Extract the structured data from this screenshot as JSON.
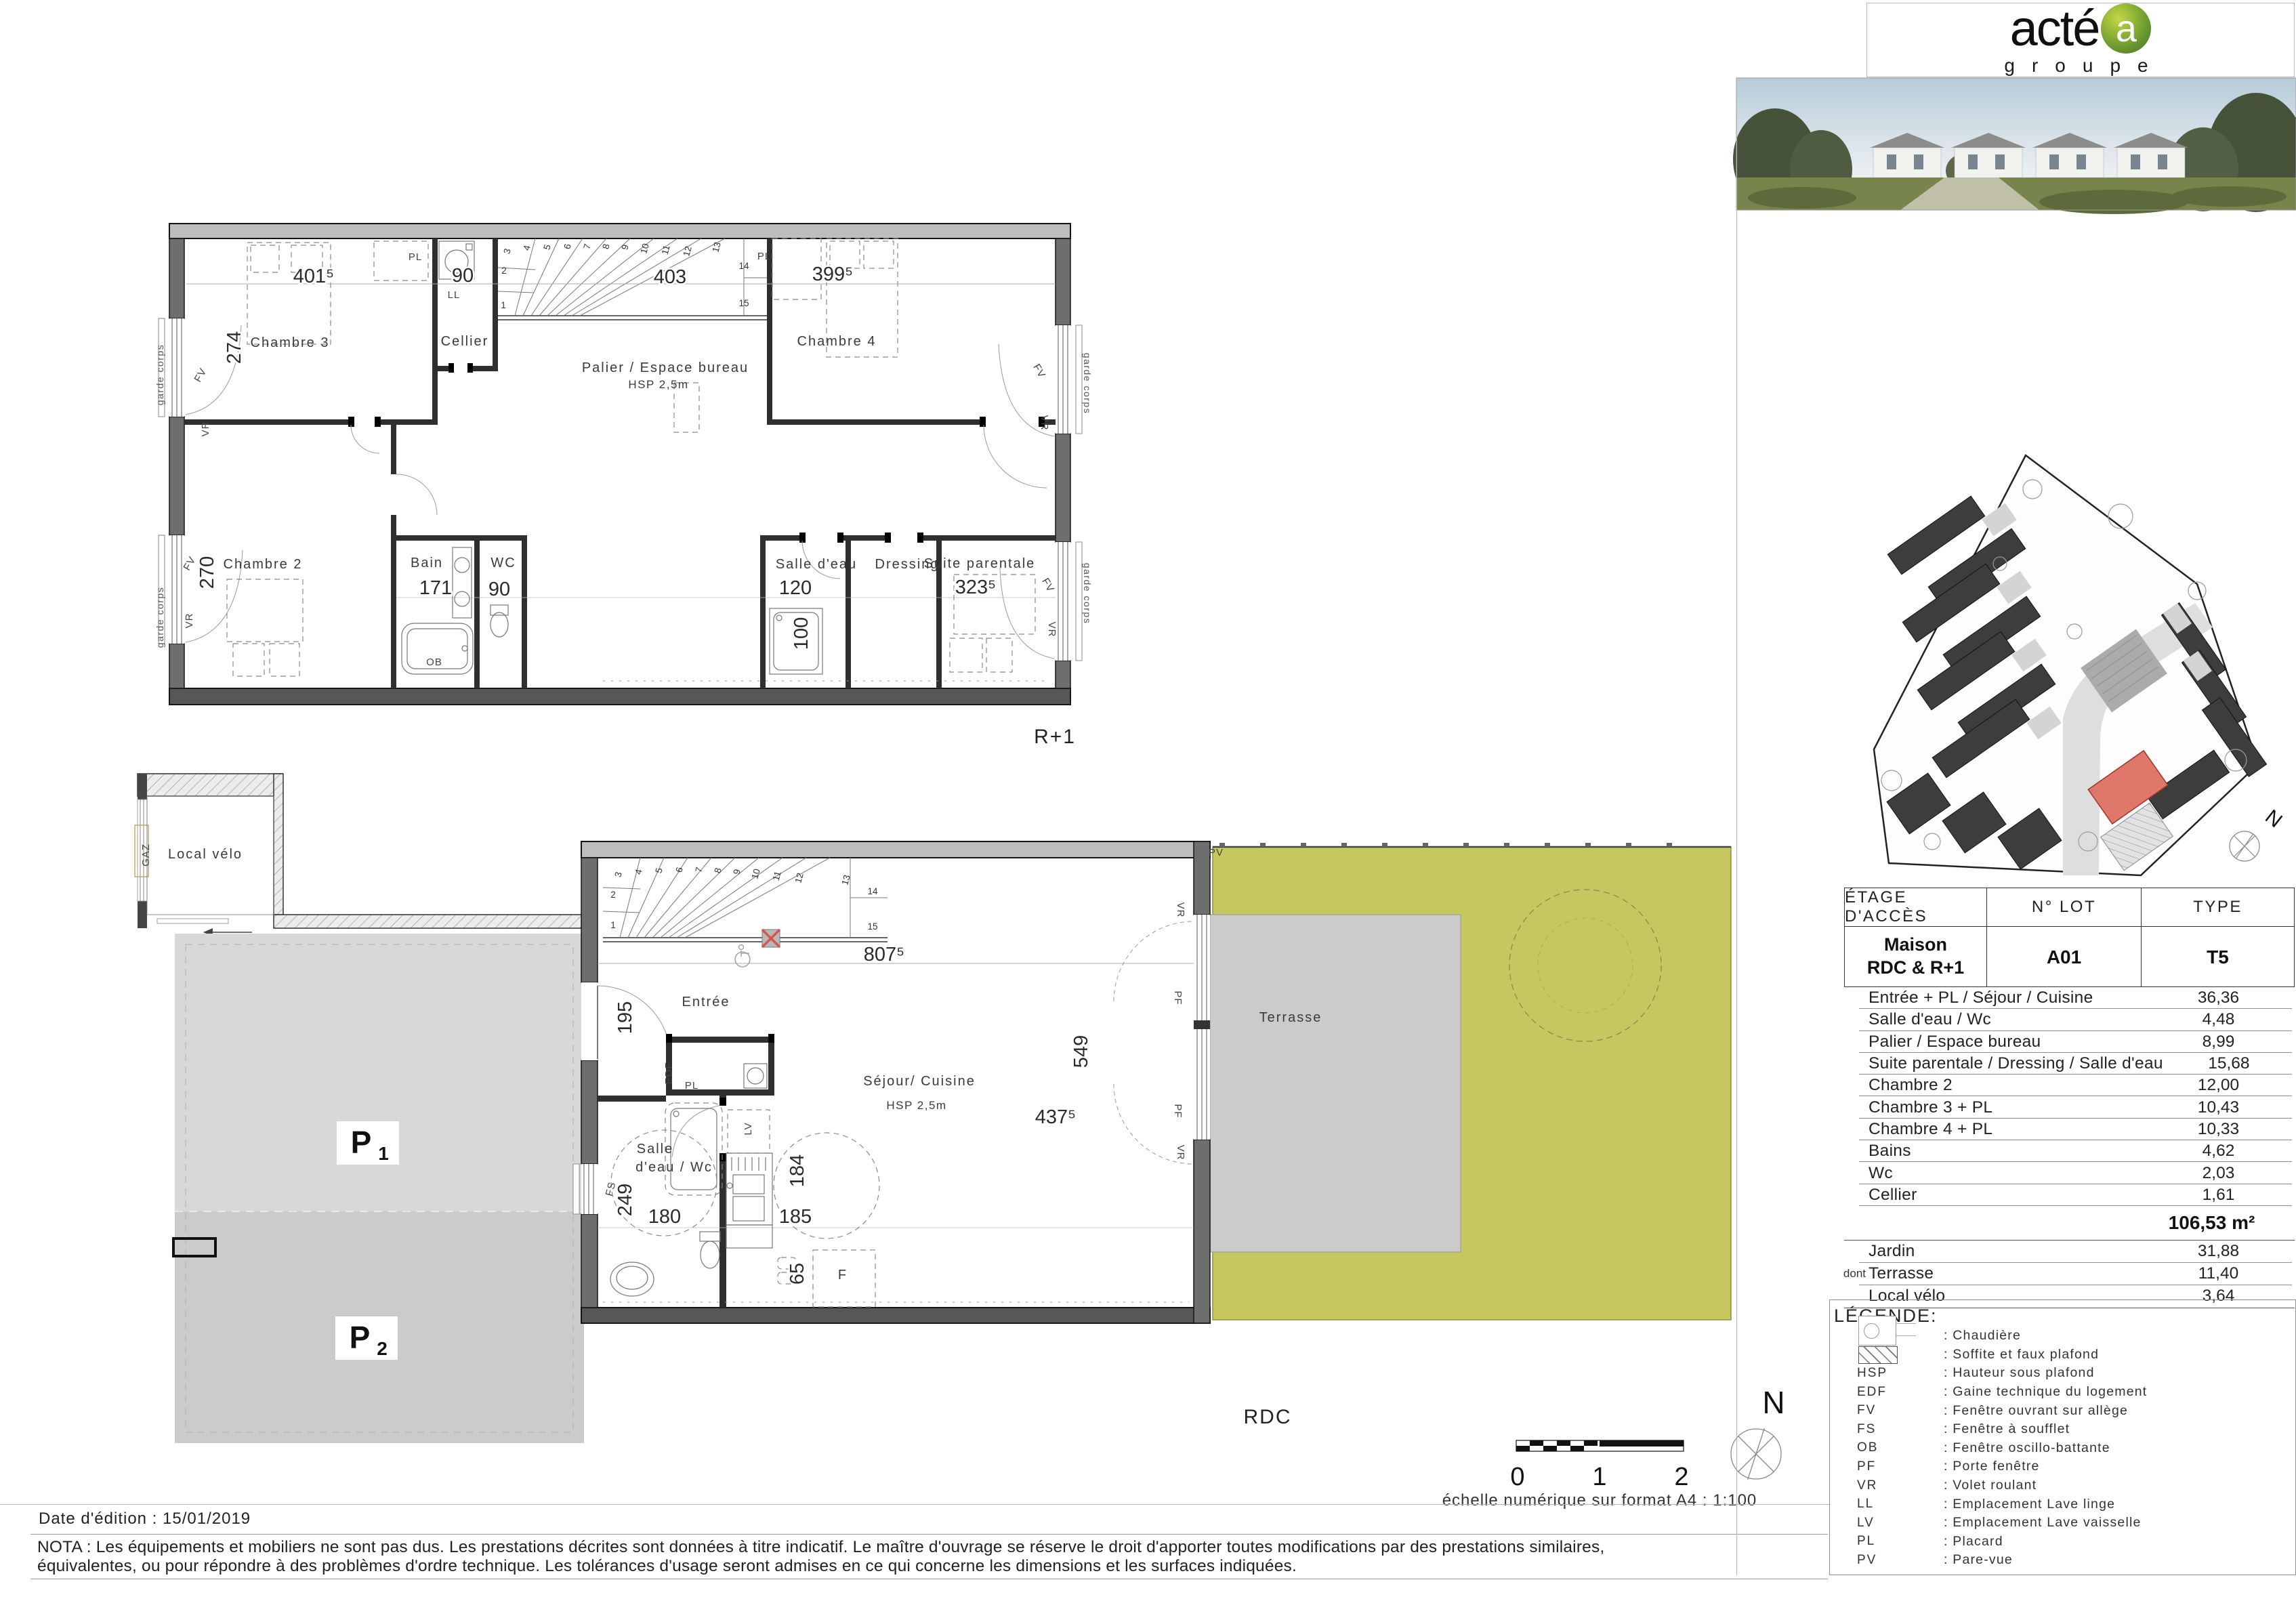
{
  "logo": {
    "word": "acté",
    "badge": "a",
    "subtitle": "groupe"
  },
  "scale": {
    "zero": "0",
    "one": "1",
    "two": "2",
    "caption": "échelle numérique sur format A4 : 1:100"
  },
  "compass": {
    "n": "N"
  },
  "footer": {
    "date": "Date d'édition : 15/01/2019",
    "nota1": "NOTA : Les équipements et mobiliers ne sont pas dus. Les prestations décrites sont données à titre indicatif. Le maître d'ouvrage se réserve le droit d'apporter toutes modifications par des prestations similaires,",
    "nota2": "équivalentes, ou pour répondre à des problèmes d'ordre technique. Les tolérances d'usage seront admises en ce qui concerne les dimensions et les surfaces indiquées."
  },
  "table": {
    "headers": [
      "ÉTAGE D'ACCÈS",
      "N° LOT",
      "TYPE"
    ],
    "access_line1": "Maison",
    "access_line2": "RDC & R+1",
    "lot": "A01",
    "type": "T5",
    "rooms": [
      [
        "Entrée + PL / Séjour / Cuisine",
        "36,36"
      ],
      [
        "Salle d'eau / Wc",
        "4,48"
      ],
      [
        "Palier / Espace bureau",
        "8,99"
      ],
      [
        "Suite parentale / Dressing / Salle d'eau",
        "15,68"
      ],
      [
        "Chambre 2",
        "12,00"
      ],
      [
        "Chambre 3 + PL",
        "10,43"
      ],
      [
        "Chambre 4 + PL",
        "10,33"
      ],
      [
        "Bains",
        "4,62"
      ],
      [
        "Wc",
        "2,03"
      ],
      [
        "Cellier",
        "1,61"
      ]
    ],
    "total": "106,53 m²",
    "outdoor": [
      [
        "",
        "Jardin",
        "31,88"
      ],
      [
        "dont",
        "Terrasse",
        "11,40"
      ],
      [
        "",
        "Local vélo",
        "3,64"
      ]
    ]
  },
  "legend": {
    "title": "LÉGENDE:",
    "items": [
      [
        "",
        "chaudiere",
        ": Chaudière"
      ],
      [
        "",
        "soffite",
        ": Soffite et faux plafond"
      ],
      [
        "HSP",
        "",
        ": Hauteur sous plafond"
      ],
      [
        "EDF",
        "",
        ": Gaine technique du logement"
      ],
      [
        "FV",
        "",
        ": Fenêtre ouvrant sur allège"
      ],
      [
        "FS",
        "",
        ": Fenêtre à soufflet"
      ],
      [
        "OB",
        "",
        ": Fenêtre oscillo-battante"
      ],
      [
        "PF",
        "",
        ": Porte fenêtre"
      ],
      [
        "VR",
        "",
        ": Volet roulant"
      ],
      [
        "LL",
        "",
        ": Emplacement Lave linge"
      ],
      [
        "LV",
        "",
        ": Emplacement Lave vaisselle"
      ],
      [
        "PL",
        "",
        ": Placard"
      ],
      [
        "PV",
        "",
        ": Pare-vue"
      ]
    ]
  },
  "plans": {
    "r1_title": "R+1",
    "rdc_title": "RDC",
    "labels": {
      "chambre2": "Chambre 2",
      "chambre3": "Chambre 3",
      "chambre4": "Chambre 4",
      "cellier": "Cellier",
      "palier": "Palier / Espace bureau",
      "hsp": "HSP 2,5m",
      "bain": "Bain",
      "wc": "WC",
      "salledeau": "Salle d'eau",
      "dressing": "Dressing",
      "suite": "Suite parentale",
      "entree": "Entrée",
      "sejour": "Séjour/ Cuisine",
      "sdewc1": "Salle",
      "sdewc2": "d'eau / Wc",
      "terrasse": "Terrasse",
      "localvelo": "Local vélo",
      "gardecorps": "garde corps"
    },
    "tags": {
      "pl": "PL",
      "ll": "LL",
      "lv": "LV",
      "ob": "OB",
      "fv": "FV",
      "vr": "VR",
      "fs": "FS",
      "pf": "PF",
      "pv": "PV",
      "edf": "EDF",
      "gaz": "GAZ",
      "f": "F"
    },
    "dims": {
      "d4015": "401⁵",
      "d90": "90",
      "d403": "403",
      "d3995": "399⁵",
      "d274": "274",
      "d270": "270",
      "d171": "171",
      "d90b": "90",
      "d120": "120",
      "d3235": "323⁵",
      "d100": "100",
      "d8075": "807⁵",
      "d195": "195",
      "d249": "249",
      "d180": "180",
      "d185": "185",
      "d184": "184",
      "d65": "65",
      "d549": "549",
      "d4375": "437⁵"
    },
    "stairs": [
      "1",
      "2",
      "3",
      "4",
      "5",
      "6",
      "7",
      "8",
      "9",
      "10",
      "11",
      "12",
      "13",
      "14",
      "15"
    ],
    "parking": {
      "p": "P",
      "p1": "1",
      "p2": "2"
    }
  }
}
